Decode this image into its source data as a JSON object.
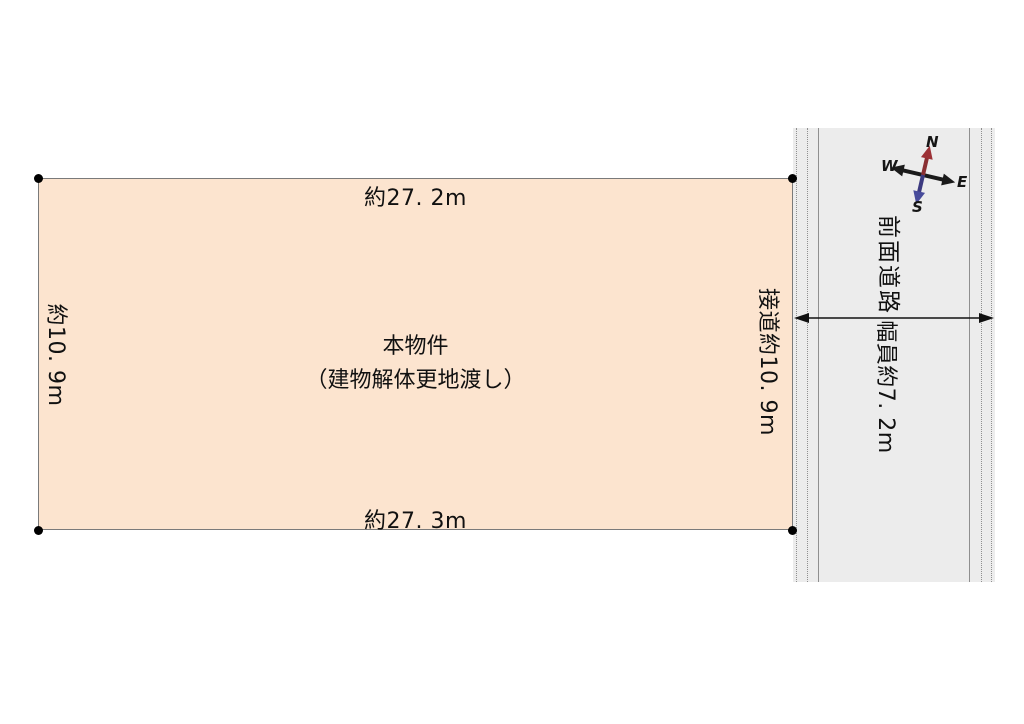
{
  "property": {
    "name_line1": "本物件",
    "name_line2": "（建物解体更地渡し）",
    "dim_top": "約27. 2m",
    "dim_bottom": "約27. 3m",
    "dim_left": "約10. 9m",
    "dim_right": "接道約10. 9m"
  },
  "road": {
    "name": "前面道路",
    "width_label": "幅員約7. 2m"
  },
  "compass": {
    "n": "N",
    "e": "E",
    "s": "S",
    "w": "W"
  },
  "colors": {
    "property_fill": "#fce4cf",
    "property_border": "#7a7a7a",
    "road_fill": "#ececec",
    "road_line": "#8f8f8f",
    "north_label": "#c1272d",
    "south_label": "#2b5fad",
    "text": "#111111"
  }
}
